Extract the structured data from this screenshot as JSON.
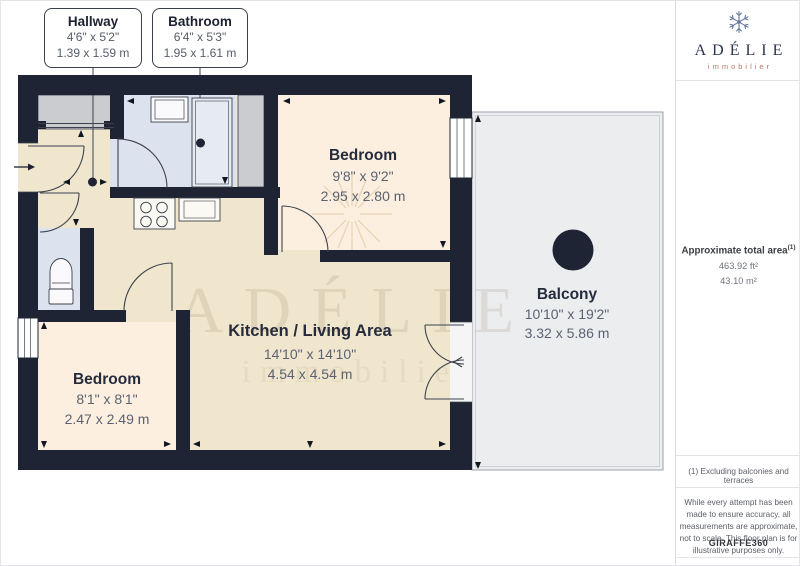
{
  "callouts": {
    "hallway": {
      "name": "Hallway",
      "imperial": "4'6\" x 5'2\"",
      "metric": "1.39 x 1.59 m"
    },
    "bathroom": {
      "name": "Bathroom",
      "imperial": "6'4\" x 5'3\"",
      "metric": "1.95 x 1.61 m"
    }
  },
  "rooms": {
    "bedroom_top": {
      "name": "Bedroom",
      "imperial": "9'8\" x 9'2\"",
      "metric": "2.95 x 2.80 m"
    },
    "bedroom_left": {
      "name": "Bedroom",
      "imperial": "8'1\" x 8'1\"",
      "metric": "2.47 x 2.49 m"
    },
    "kitchen_living": {
      "name": "Kitchen / Living Area",
      "imperial": "14'10\" x 14'10\"",
      "metric": "4.54 x 4.54 m"
    },
    "balcony": {
      "name": "Balcony",
      "imperial": "10'10\" x 19'2\"",
      "metric": "3.32 x 5.86 m"
    }
  },
  "watermark": {
    "line1": "ADÉLIE",
    "line2": "immobilier"
  },
  "sidebar": {
    "brand": {
      "name": "ADÉLIE",
      "tagline": "immobilier"
    },
    "area": {
      "label": "Approximate total area",
      "footnote_marker": "(1)",
      "imperial": "463.92 ft²",
      "metric": "43.10 m²"
    },
    "footnote": "(1) Excluding balconies and terraces",
    "disclaimer": "While every attempt has been made to ensure accuracy, all measurements are approximate, not to scale. This floor plan is for illustrative purposes only.",
    "credit_brand": "GIRAFFE",
    "credit_suffix": "360"
  },
  "colors": {
    "wall": "#1e2433",
    "floor_living": "#f0e6ce",
    "floor_bedroom": "#fcefdf",
    "floor_bath": "#dce2ee",
    "closet_gray": "#cbccd0",
    "balcony_fill": "#ecedef",
    "brand_navy": "#2d3450",
    "brand_salmon": "#c1746a"
  }
}
